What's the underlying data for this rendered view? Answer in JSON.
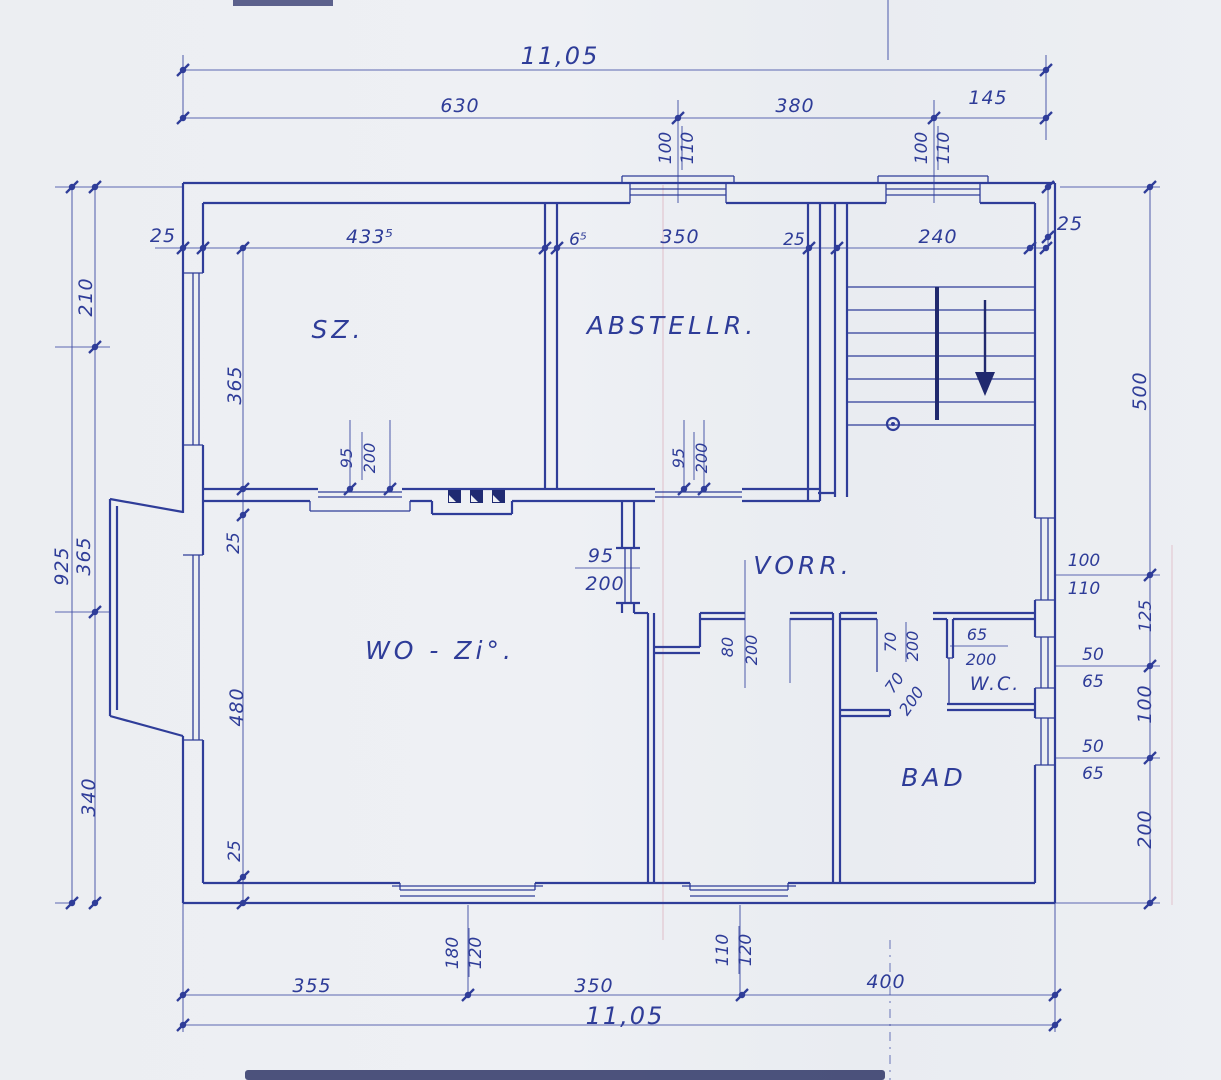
{
  "rooms": {
    "sz": "SZ.",
    "abstellr": "ABSTELLR.",
    "vorr": "VORR.",
    "wozi": "WO - Zi°.",
    "bad": "BAD",
    "wc": "W.C."
  },
  "dims": {
    "overall_top": "11,05",
    "top_630": "630",
    "top_380": "380",
    "top_145": "145",
    "wall_25_topleft": "25",
    "sz_width": "433⁵",
    "gap_65": "6⁵",
    "abst_width": "350",
    "abst_wall_25": "25",
    "stair_width": "240",
    "wall_25_topright": "25",
    "left_925": "925",
    "left_210": "210",
    "left_365": "365",
    "left_340": "340",
    "inner_365": "365",
    "inner_25_top": "25",
    "inner_480": "480",
    "inner_25_bottom": "25",
    "right_500": "500",
    "right_125": "125",
    "right_100": "100",
    "right_200": "200",
    "bottom_355": "355",
    "bottom_350": "350",
    "bottom_400": "400",
    "overall_bottom": "11,05"
  },
  "windows": {
    "top1": {
      "w": "100",
      "h": "110"
    },
    "top2": {
      "w": "100",
      "h": "110"
    },
    "right1": {
      "w": "100",
      "h": "110"
    },
    "right2": {
      "w": "50",
      "h": "65"
    },
    "right3": {
      "w": "50",
      "h": "65"
    },
    "bottom1": {
      "w": "180",
      "h": "120"
    },
    "bottom2": {
      "w": "110",
      "h": "120"
    }
  },
  "doors": {
    "sz": {
      "w": "95",
      "h": "200"
    },
    "abstellr": {
      "w": "95",
      "h": "200"
    },
    "vorr": {
      "w": "95",
      "h": "200"
    },
    "middle": {
      "w": "80",
      "h": "200"
    },
    "bad": {
      "w": "70",
      "h": "200"
    },
    "wc": {
      "w": "70",
      "h": "200"
    },
    "wc_65": {
      "w": "65",
      "h": "200"
    }
  },
  "colors": {
    "ink": "#2f3d99",
    "ink_dark": "#20296e",
    "paper": "#edeff3",
    "hairline_pink": "#d897a8"
  }
}
